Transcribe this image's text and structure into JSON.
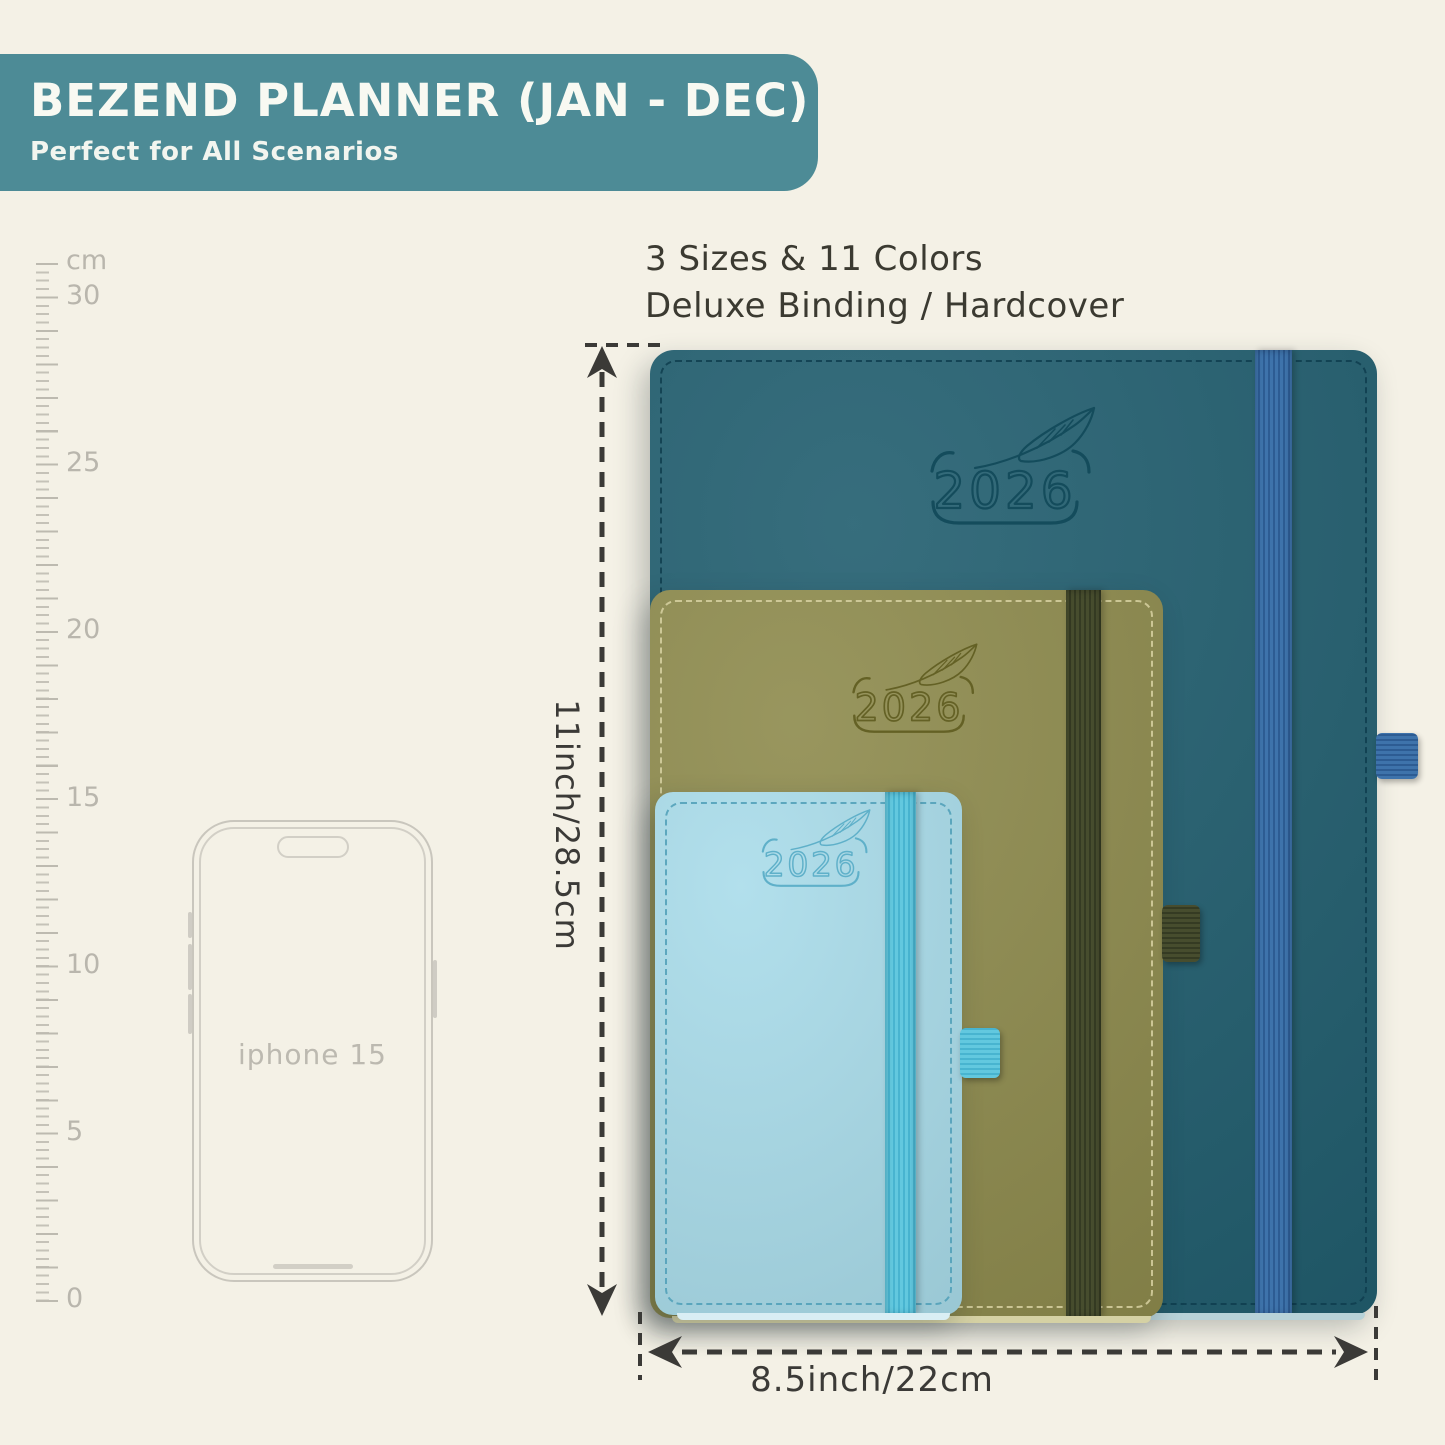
{
  "banner": {
    "title": "BEZEND PLANNER (JAN - DEC)",
    "subtitle": "Perfect for All Scenarios",
    "bg_color": "#4d8b96",
    "text_color": "#f8f9f2"
  },
  "headline": {
    "line1": "3 Sizes & 11 Colors",
    "line2": "Deluxe Binding / Hardcover"
  },
  "ruler": {
    "unit_label": "cm",
    "tick_labels": [
      "30",
      "25",
      "20",
      "15",
      "10",
      "5",
      "0"
    ]
  },
  "phone": {
    "label": "iphone 15"
  },
  "planners": [
    {
      "name": "large",
      "year": "2026",
      "cover_color": "#205d6e",
      "band_color": "#3e73ab"
    },
    {
      "name": "medium",
      "year": "2026",
      "cover_color": "#8d8a4c",
      "band_color": "#474d2e"
    },
    {
      "name": "small",
      "year": "2026",
      "cover_color": "#a9dcea",
      "band_color": "#62c8df"
    }
  ],
  "dimensions": {
    "height_label": "11inch/28.5cm",
    "width_label": "8.5inch/22cm"
  }
}
